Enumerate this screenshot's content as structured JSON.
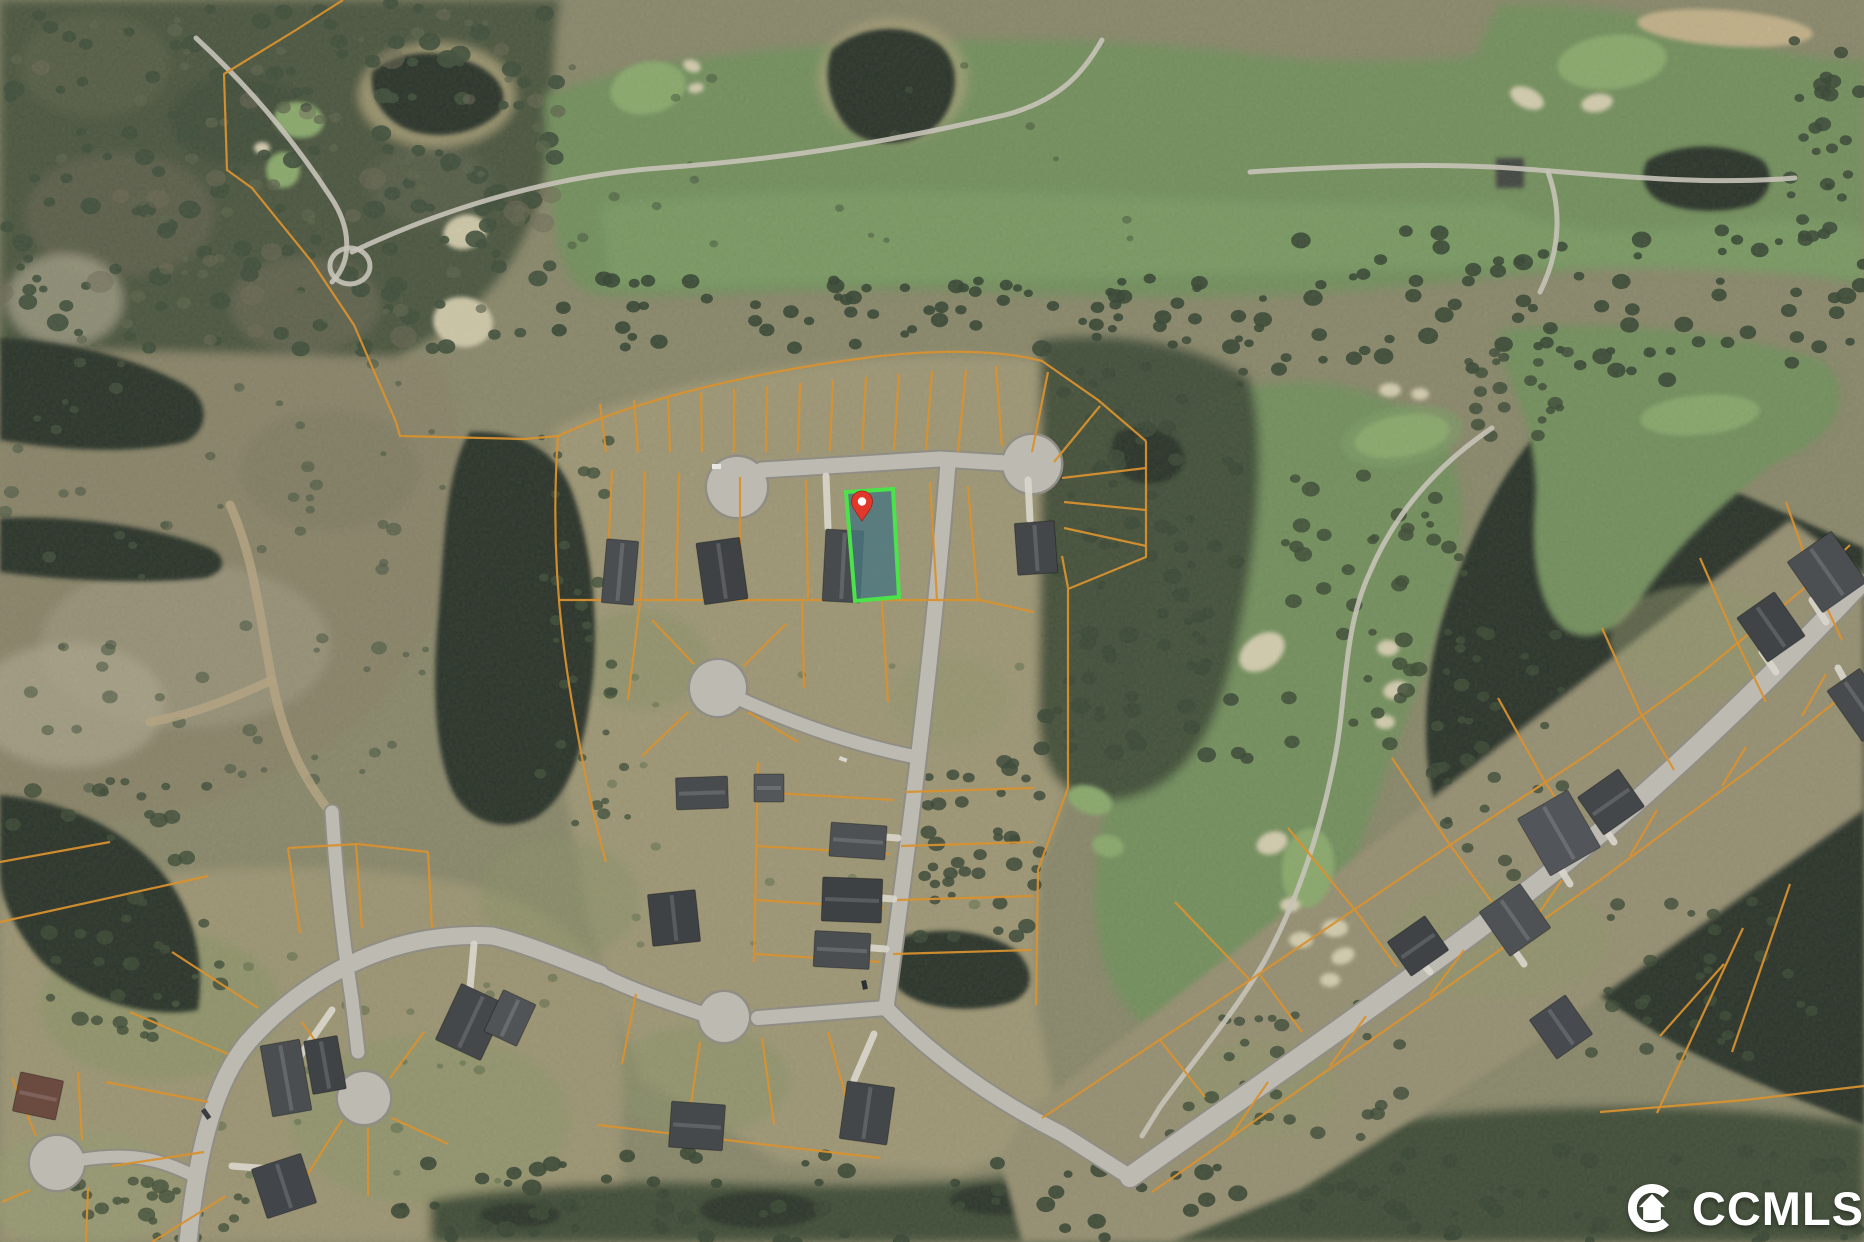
{
  "watermark": {
    "text": "CCMLS",
    "icon": "ccmls-crescent-house-logo",
    "color": "#ffffff"
  },
  "subject_lot": {
    "points": "846,492 893,489 899,597 855,601",
    "fill": "#49767f",
    "stroke": "#4ce24a"
  },
  "subject_pin": {
    "transform": "translate(862,521)",
    "body_color": "#e2382c",
    "dot_color": "#ffffff"
  },
  "palette": {
    "base": "#8e8a6c",
    "lot_line": "#d8912f",
    "road_fill": "#bdbab2",
    "road_edge": "#908d85",
    "water": "#212a21",
    "fairway": "#74935d",
    "putting_green": "#8fb06e",
    "sand": "#e2d8ba",
    "scrub": "#a39a77",
    "forest": "#47513b",
    "marsh": "#3a4732",
    "wm_color": "#ffffff"
  }
}
